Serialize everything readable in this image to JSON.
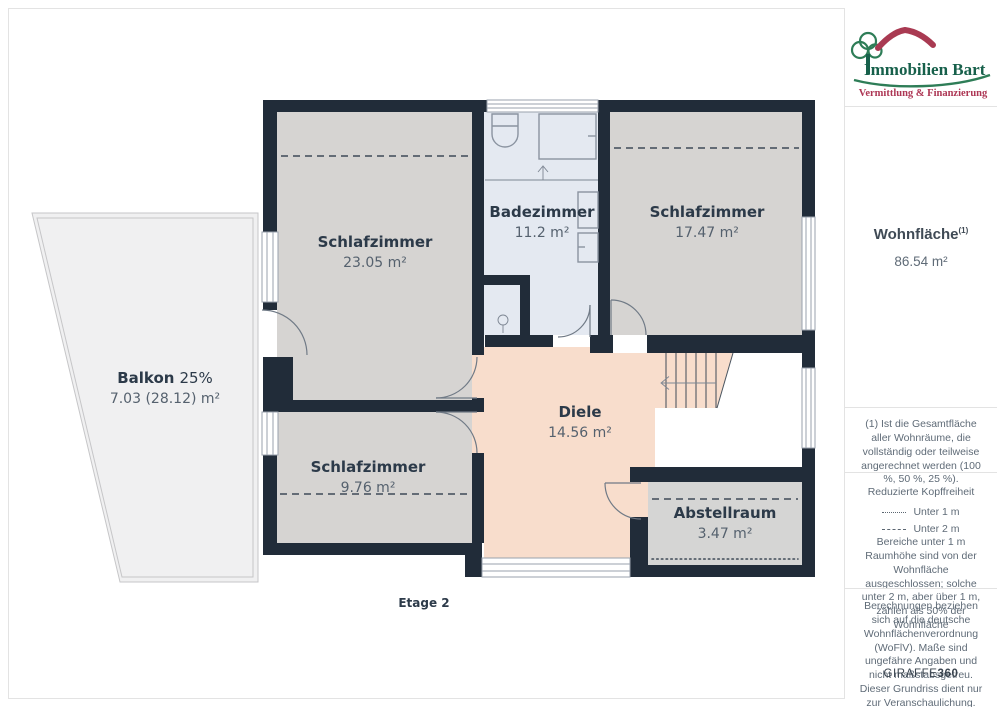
{
  "branding": {
    "title": "Immobilien Bart",
    "subtitle": "Vermittlung & Finanzierung"
  },
  "sidebar": {
    "living_area_label": "Wohnfläche",
    "living_area_superscript": "(1)",
    "living_area_value": "86.54 m²",
    "footnote": "(1) Ist die Gesamtfläche aller Wohnräume, die vollständig oder teilweise angerechnet werden (100 %, 50 %, 25 %).",
    "headroom": {
      "title": "Reduzierte Kopffreiheit",
      "legend": [
        {
          "style": "dotted",
          "label": "Unter 1 m"
        },
        {
          "style": "dashed",
          "label": "Unter 2 m"
        }
      ],
      "note": "Bereiche unter 1 m Raumhöhe sind von der Wohnfläche ausgeschlossen; solche unter 2 m, aber über 1 m, zählen als 50% der Wohnfläche"
    },
    "disclaimer": "Berechnungen beziehen sich auf die deutsche Wohnflächenverordnung (WoFlV). Maße sind ungefähre Angaben und nicht maßstabsgetreu. Dieser Grundriss dient nur zur Veranschaulichung.",
    "brand_footer": {
      "name": "GIRAFFE",
      "suffix": "360"
    }
  },
  "plan": {
    "floor_label": "Etage 2",
    "rooms": [
      {
        "name": "Schlafzimmer",
        "area": "23.05 m²"
      },
      {
        "name": "Badezimmer",
        "area": "11.2 m²"
      },
      {
        "name": "Schlafzimmer",
        "area": "17.47 m²"
      },
      {
        "name": "Balkon",
        "percent": "25%",
        "area": "7.03 (28.12) m²"
      },
      {
        "name": "Diele",
        "area": "14.56 m²"
      },
      {
        "name": "Schlafzimmer",
        "area": "9.76 m²"
      },
      {
        "name": "Abstellraum",
        "area": "3.47 m²"
      }
    ]
  },
  "colors": {
    "wall": "#212c39",
    "floor-room": "#d6d4d2",
    "floor-bath": "#e4e9f1",
    "floor-hall": "#f8ddcc",
    "floor-storage": "#d5d5d4",
    "floor-balcony": "#f0f0f1",
    "line-dark": "#3f4a57",
    "fixture": "#8a93a0",
    "text-dark": "#2c3a49",
    "text-muted": "#55616e",
    "sidebar-text": "#5f6b77",
    "divider": "#e3e3e3",
    "brand-green": "#2e7d57",
    "brand-green-dark": "#17604b",
    "brand-red": "#a93a52",
    "brand-crimson": "#ad3654"
  }
}
